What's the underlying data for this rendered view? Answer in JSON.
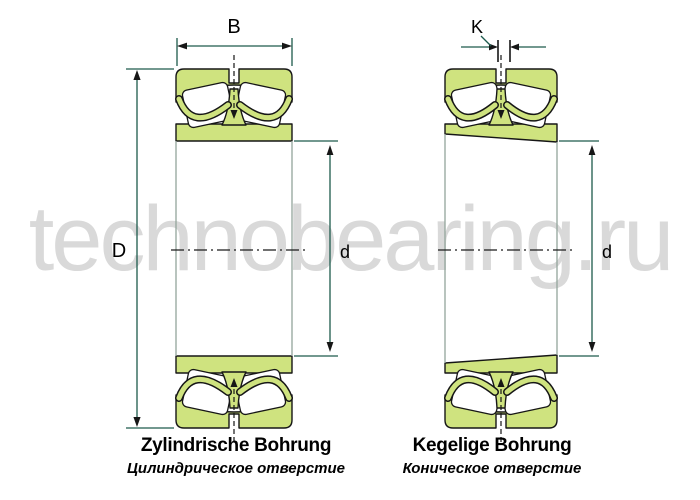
{
  "watermark": {
    "text": "technobearing.ru"
  },
  "colors": {
    "ring_fill": "#cfe37f",
    "outline": "#161616",
    "dim": "#1d5a4c",
    "side": "#93a59c",
    "watermark": "#d9d9d9",
    "label": "#000000"
  },
  "dimensions": {
    "width_label": "B",
    "taper_label": "K",
    "outer_diameter_label": "D",
    "bore_left_label": "d",
    "bore_right_label": "d"
  },
  "bearings": {
    "left": {
      "title": "Zylindrische Bohrung",
      "subtitle": "Цилиндрическое отверстие",
      "bore_type": "cylindrical bore"
    },
    "right": {
      "title": "Kegelige Bohrung",
      "subtitle": "Коническое отверстие",
      "bore_type": "tapered bore"
    }
  }
}
